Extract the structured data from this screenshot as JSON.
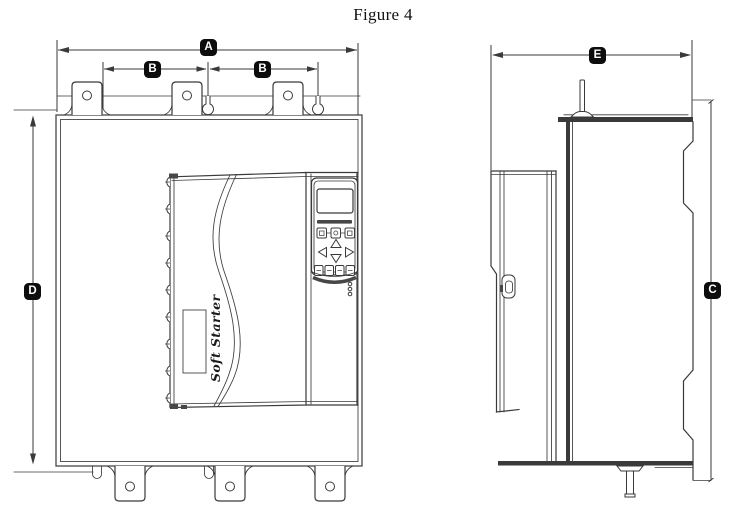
{
  "figure": {
    "title": "Figure 4"
  },
  "device": {
    "panel_text": "Soft Starter"
  },
  "dims": {
    "a": {
      "label": "A",
      "meaning": "overall width"
    },
    "b_left": {
      "label": "B",
      "meaning": "mounting hole spacing left"
    },
    "b_right": {
      "label": "B",
      "meaning": "mounting hole spacing right"
    },
    "c": {
      "label": "C",
      "meaning": "side overall height"
    },
    "d": {
      "label": "D",
      "meaning": "front overall height"
    },
    "e": {
      "label": "E",
      "meaning": "overall depth"
    }
  },
  "colors": {
    "line": "#3a3a3a",
    "badge_bg": "#0d0d0d",
    "badge_text": "#ffffff",
    "background": "#ffffff"
  },
  "icons": {
    "keypad": [
      "display",
      "function-buttons",
      "up-arrow",
      "down-arrow",
      "left-arrow",
      "right-arrow",
      "status-leds"
    ]
  }
}
